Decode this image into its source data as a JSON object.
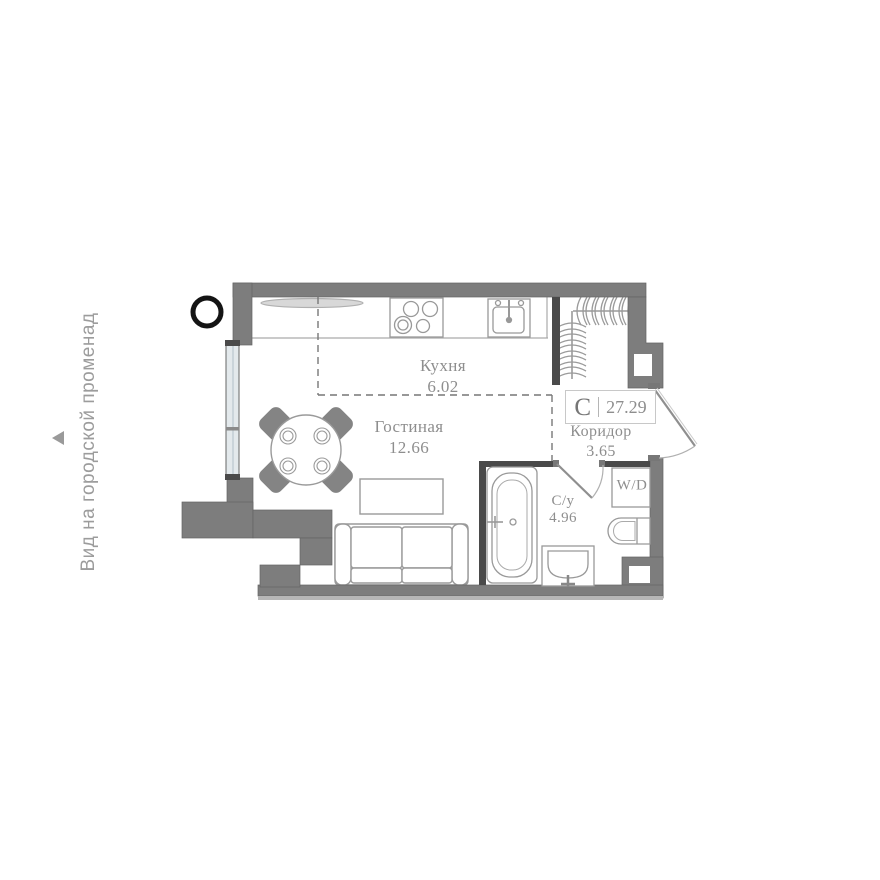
{
  "side_note": {
    "text": "Вид на городской променад"
  },
  "unit_badge": {
    "type_letter": "С",
    "total_area": "27.29"
  },
  "rooms": {
    "kitchen": {
      "name": "Кухня",
      "area": "6.02"
    },
    "living": {
      "name": "Гостиная",
      "area": "12.66"
    },
    "corridor": {
      "name": "Коридор",
      "area": "3.65"
    },
    "bathroom": {
      "name": "С/у",
      "area": "4.96"
    }
  },
  "appliances": {
    "washer_dryer": "W/D"
  },
  "colors": {
    "wall": "#7d7d7d",
    "interior_wall": "#4a4a4a",
    "furniture_outline": "#9a9a9a",
    "label_text": "#8e8e8e",
    "window_glass": "#e3e9ec",
    "marker": "#141414"
  }
}
